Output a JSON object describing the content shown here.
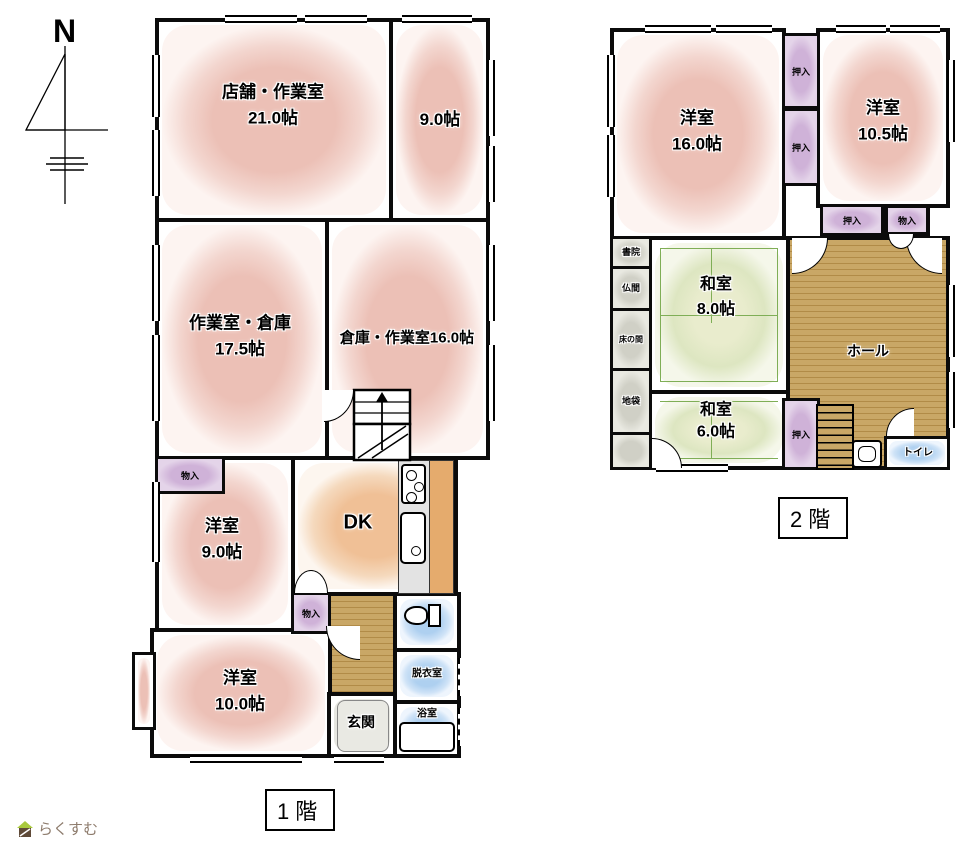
{
  "page": {
    "compass": "N",
    "floor1_label": "1階",
    "floor2_label": "2階",
    "logo": "らくすむ"
  },
  "f1": {
    "shop_name": "店舗・作業室",
    "shop_size": "21.0帖",
    "r9_size": "9.0帖",
    "work_name": "作業室・倉庫",
    "work_size": "17.5帖",
    "storage_name": "倉庫・作業室16.0帖",
    "west9_name": "洋室",
    "west9_size": "9.0帖",
    "dk": "DK",
    "west10_name": "洋室",
    "west10_size": "10.0帖",
    "genkan": "玄関",
    "datsui": "脱衣室",
    "bath": "浴室",
    "closet_a": "物入",
    "closet_b": "物入"
  },
  "f2": {
    "west16_name": "洋室",
    "west16_size": "16.0帖",
    "west105_name": "洋室",
    "west105_size": "10.5帖",
    "oshiire_a": "押入",
    "oshiire_b": "押入",
    "oshiire_c": "押入",
    "oshiire_d": "押入",
    "monoire": "物入",
    "shoin": "書院",
    "butsuma": "仏間",
    "tokonoma": "床の間",
    "jibukuro": "地袋",
    "washitsu8_name": "和室",
    "washitsu8_size": "8.0帖",
    "washitsu6_name": "和室",
    "washitsu6_size": "6.0帖",
    "hall": "ホール",
    "toilet": "トイレ"
  },
  "colors": {
    "room_pink": "#ecc0b6",
    "dk_orange": "#f0c096",
    "tatami_green": "#dce5c0",
    "wood_floor": "#c7a566",
    "wet_blue": "#aed0f0",
    "closet_purple": "#d9c2de",
    "wall": "#0b0b0b"
  }
}
